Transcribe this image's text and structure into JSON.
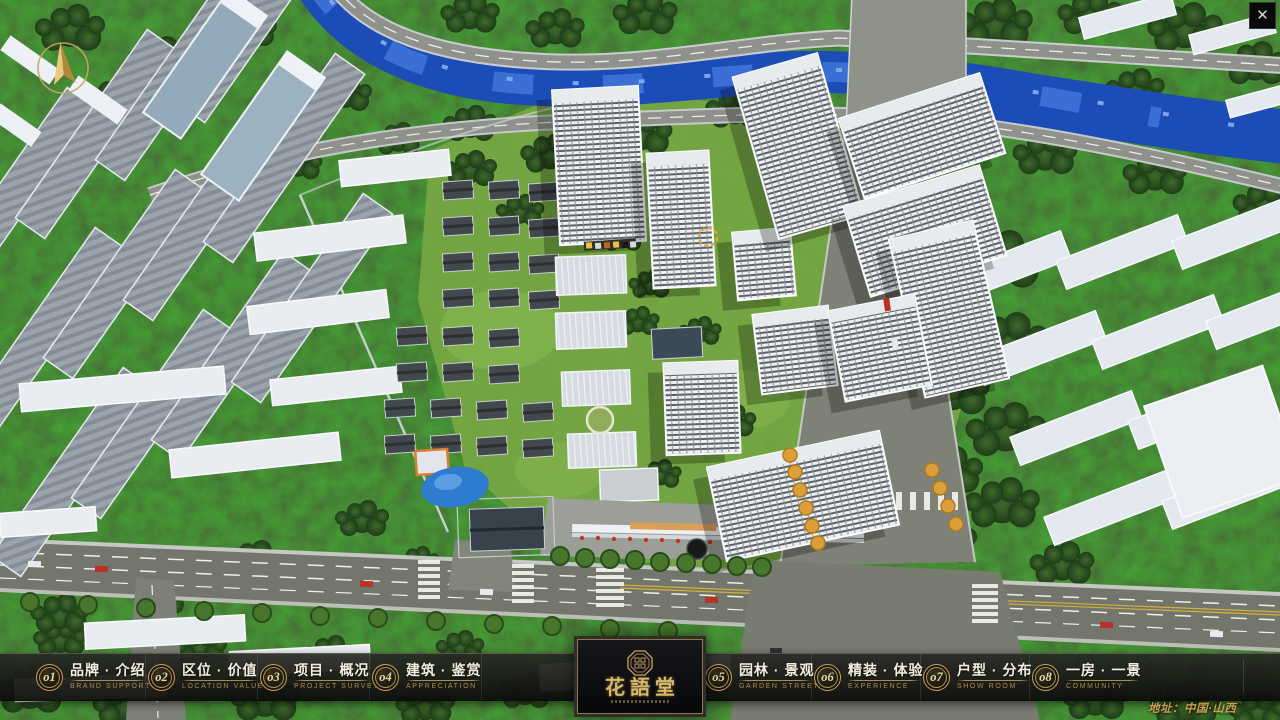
{
  "window": {
    "close_glyph": "✕"
  },
  "colors": {
    "gold_accent": "#c9a35e",
    "bar_background": "#121210",
    "address_gold": "#c9a251",
    "river_blue": "#1c4cb5"
  },
  "nav": {
    "items": [
      {
        "num": "o1",
        "label_zh": "品牌 · 介绍",
        "label_en": "BRAND SUPPORT"
      },
      {
        "num": "o2",
        "label_zh": "区位 · 价值",
        "label_en": "LOCATION VALUE"
      },
      {
        "num": "o3",
        "label_zh": "项目 · 概况",
        "label_en": "PROJECT SURVEY"
      },
      {
        "num": "o4",
        "label_zh": "建筑 · 鉴赏",
        "label_en": "APPRECIATION"
      },
      {
        "num": "o5",
        "label_zh": "园林 · 景观",
        "label_en": "GARDEN STREET"
      },
      {
        "num": "o6",
        "label_zh": "精装 · 体验",
        "label_en": "EXPERIENCE"
      },
      {
        "num": "o7",
        "label_zh": "户型 · 分布",
        "label_en": "SHOW ROOM"
      },
      {
        "num": "o8",
        "label_zh": "一房 · 一景",
        "label_en": "COMMUNITY"
      }
    ]
  },
  "logo": {
    "title": "花語堂"
  },
  "footer": {
    "address": "地址：中国·山西"
  }
}
